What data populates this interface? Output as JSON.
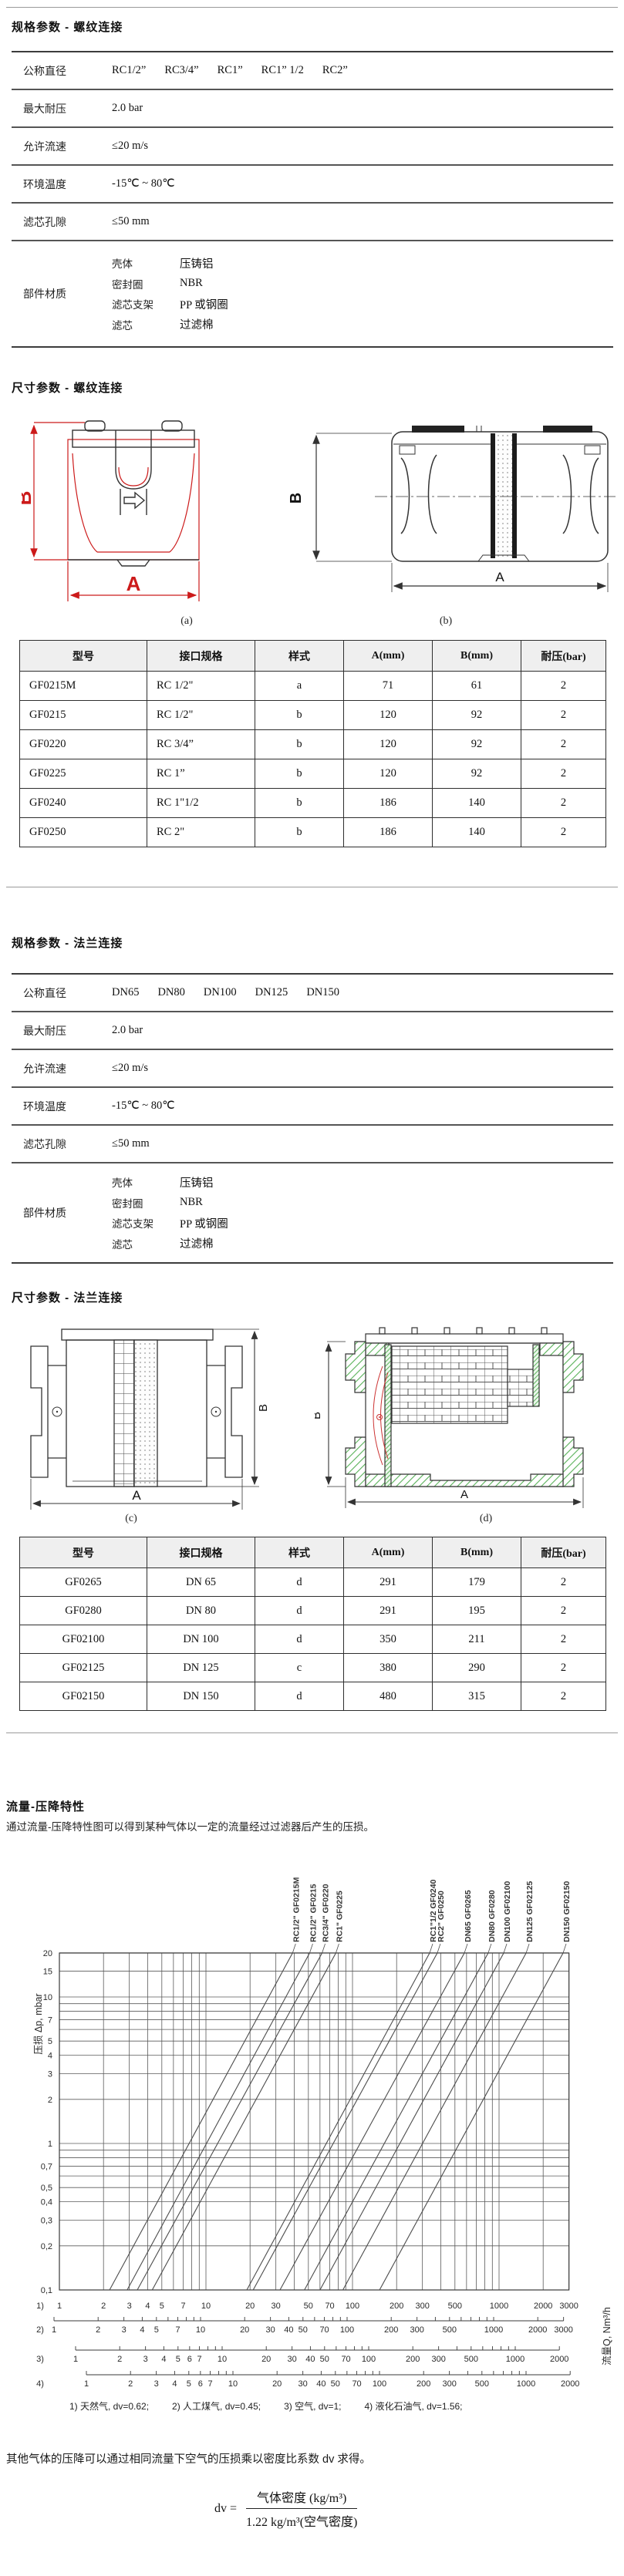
{
  "page": {
    "section1_title": "规格参数 - 螺纹连接",
    "section2_title": "尺寸参数 - 螺纹连接",
    "section3_title": "规格参数 - 法兰连接",
    "section4_title": "尺寸参数 - 法兰连接",
    "section5_title": "流量-压降特性",
    "intro": "通过流量-压降特性图可以得到某种气体以一定的流量经过过滤器后产生的压损。",
    "note": "其他气体的压降可以通过相同流量下空气的压损乘以密度比系数 dv 求得。",
    "formula": {
      "lhs": "dv =",
      "numerator": "气体密度 (kg/m³)",
      "denominator": "1.22 kg/m³(空气密度)"
    },
    "fig_labels": {
      "a": "(a)",
      "b": "(b)",
      "c": "(c)",
      "d": "(d)"
    },
    "dims": {
      "A": "A",
      "B": "B"
    },
    "colors": {
      "accent_red": "#cc1a1a",
      "hatch_green": "#58b158",
      "line_dark": "#333333"
    }
  },
  "spec_threaded": {
    "rows": [
      {
        "label": "公称直径",
        "values": [
          "RC1/2”",
          "RC3/4”",
          "RC1”",
          "RC1” 1/2",
          "RC2”"
        ]
      },
      {
        "label": "最大耐压",
        "values": [
          "2.0 bar"
        ]
      },
      {
        "label": "允许流速",
        "values": [
          "≤20 m/s"
        ]
      },
      {
        "label": "环境温度",
        "values": [
          "-15℃ ~ 80℃"
        ]
      },
      {
        "label": "滤芯孔隙",
        "values": [
          "≤50 mm"
        ]
      },
      {
        "label": "部件材质",
        "materials": [
          [
            "壳体",
            "压铸铝"
          ],
          [
            "密封圈",
            "NBR"
          ],
          [
            "滤芯支架",
            "PP 或钢圈"
          ],
          [
            "滤芯",
            "过滤棉"
          ]
        ]
      }
    ]
  },
  "spec_flange": {
    "rows": [
      {
        "label": "公称直径",
        "values": [
          "DN65",
          "DN80",
          "DN100",
          "DN125",
          "DN150"
        ]
      },
      {
        "label": "最大耐压",
        "values": [
          "2.0 bar"
        ]
      },
      {
        "label": "允许流速",
        "values": [
          "≤20 m/s"
        ]
      },
      {
        "label": "环境温度",
        "values": [
          "-15℃ ~ 80℃"
        ]
      },
      {
        "label": "滤芯孔隙",
        "values": [
          "≤50 mm"
        ]
      },
      {
        "label": "部件材质",
        "materials": [
          [
            "壳体",
            "压铸铝"
          ],
          [
            "密封圈",
            "NBR"
          ],
          [
            "滤芯支架",
            "PP 或钢圈"
          ],
          [
            "滤芯",
            "过滤棉"
          ]
        ]
      }
    ]
  },
  "dim_threaded": {
    "headers": [
      "型号",
      "接口规格",
      "样式",
      "A(mm)",
      "B(mm)",
      "耐压(bar)"
    ],
    "rows": [
      [
        "GF0215M",
        "RC 1/2\"",
        "a",
        "71",
        "61",
        "2"
      ],
      [
        "GF0215",
        "RC 1/2\"",
        "b",
        "120",
        "92",
        "2"
      ],
      [
        "GF0220",
        "RC 3/4”",
        "b",
        "120",
        "92",
        "2"
      ],
      [
        "GF0225",
        "RC 1”",
        "b",
        "120",
        "92",
        "2"
      ],
      [
        "GF0240",
        "RC 1\"1/2",
        "b",
        "186",
        "140",
        "2"
      ],
      [
        "GF0250",
        "RC 2\"",
        "b",
        "186",
        "140",
        "2"
      ]
    ]
  },
  "dim_flange": {
    "headers": [
      "型号",
      "接口规格",
      "样式",
      "A(mm)",
      "B(mm)",
      "耐压(bar)"
    ],
    "rows": [
      [
        "GF0265",
        "DN 65",
        "d",
        "291",
        "179",
        "2"
      ],
      [
        "GF0280",
        "DN 80",
        "d",
        "291",
        "195",
        "2"
      ],
      [
        "GF02100",
        "DN 100",
        "d",
        "350",
        "211",
        "2"
      ],
      [
        "GF02125",
        "DN 125",
        "c",
        "380",
        "290",
        "2"
      ],
      [
        "GF02150",
        "DN 150",
        "d",
        "480",
        "315",
        "2"
      ]
    ]
  },
  "chart_data": {
    "type": "line",
    "title": "流量-压降特性",
    "xlabel": "流量Q, Nm³/h",
    "ylabel": "压损 Δp, mbar",
    "log_x": true,
    "log_y": true,
    "xlim": [
      1,
      3000
    ],
    "ylim": [
      0.1,
      20
    ],
    "grid": true,
    "y_gridlines": [
      0.1,
      0.2,
      0.3,
      0.4,
      0.5,
      0.6,
      0.7,
      0.8,
      0.9,
      1,
      2,
      3,
      4,
      5,
      6,
      7,
      8,
      9,
      10,
      15,
      20
    ],
    "y_ticks": [
      [
        20,
        "20"
      ],
      [
        15,
        "15"
      ],
      [
        10,
        "10"
      ],
      [
        7,
        "7"
      ],
      [
        5,
        "5"
      ],
      [
        4,
        "4"
      ],
      [
        3,
        "3"
      ],
      [
        2,
        "2"
      ],
      [
        1,
        "1"
      ],
      [
        0.7,
        "0,7"
      ],
      [
        0.5,
        "0,5"
      ],
      [
        0.4,
        "0,4"
      ],
      [
        0.3,
        "0,3"
      ],
      [
        0.2,
        "0,2"
      ],
      [
        0.1,
        "0,1"
      ]
    ],
    "series": [
      {
        "model": "GF0215M",
        "size": "RC1/2\"",
        "q_at_dp_0p1_mbar": 2.2,
        "q_at_dp_20_mbar": 39
      },
      {
        "model": "GF0215",
        "size": "RC1/2\"",
        "q_at_dp_0p1_mbar": 2.9,
        "q_at_dp_20_mbar": 51
      },
      {
        "model": "GF0220",
        "size": "RC3/4\"",
        "q_at_dp_0p1_mbar": 3.4,
        "q_at_dp_20_mbar": 62
      },
      {
        "model": "GF0225",
        "size": "RC1\"",
        "q_at_dp_0p1_mbar": 4.3,
        "q_at_dp_20_mbar": 77
      },
      {
        "model": "GF0240",
        "size": "RC1\"1/2",
        "q_at_dp_0p1_mbar": 19,
        "q_at_dp_20_mbar": 336
      },
      {
        "model": "GF0250",
        "size": "RC2\"",
        "q_at_dp_0p1_mbar": 21,
        "q_at_dp_20_mbar": 379
      },
      {
        "model": "GF0265",
        "size": "DN65",
        "q_at_dp_0p1_mbar": 32,
        "q_at_dp_20_mbar": 580
      },
      {
        "model": "GF0280",
        "size": "DN80",
        "q_at_dp_0p1_mbar": 47,
        "q_at_dp_20_mbar": 843
      },
      {
        "model": "GF02100",
        "size": "DN100",
        "q_at_dp_0p1_mbar": 60,
        "q_at_dp_20_mbar": 1076
      },
      {
        "model": "GF02125",
        "size": "DN125",
        "q_at_dp_0p1_mbar": 86,
        "q_at_dp_20_mbar": 1530
      },
      {
        "model": "GF02150",
        "size": "DN150",
        "q_at_dp_0p1_mbar": 153,
        "q_at_dp_20_mbar": 2735
      }
    ],
    "axes_rows": [
      {
        "id": "1)",
        "gas": "天然气",
        "dv": "0.62",
        "max": 3000,
        "x_of_1": 77,
        "main": true,
        "labeled": [
          1,
          2,
          3,
          4,
          5,
          7,
          10,
          20,
          30,
          50,
          70,
          100,
          200,
          300,
          500,
          1000,
          2000,
          3000
        ]
      },
      {
        "id": "2)",
        "gas": "人工煤气",
        "dv": "0.45",
        "max": 3000,
        "x_of_1": 70,
        "labeled": [
          1,
          2,
          3,
          4,
          5,
          7,
          10,
          20,
          30,
          40,
          50,
          70,
          100,
          200,
          300,
          500,
          1000,
          2000,
          3000
        ]
      },
      {
        "id": "3)",
        "gas": "空气",
        "dv": "1",
        "max": 2000,
        "x_of_1": 98,
        "labeled": [
          1,
          2,
          3,
          4,
          5,
          6,
          7,
          10,
          20,
          30,
          40,
          50,
          70,
          100,
          200,
          300,
          500,
          1000,
          2000
        ]
      },
      {
        "id": "4)",
        "gas": "液化石油气",
        "dv": "1.56",
        "max": 2000,
        "x_of_1": 112,
        "labeled": [
          1,
          2,
          3,
          4,
          5,
          6,
          7,
          10,
          20,
          30,
          40,
          50,
          70,
          100,
          200,
          300,
          500,
          1000,
          2000
        ]
      }
    ]
  }
}
